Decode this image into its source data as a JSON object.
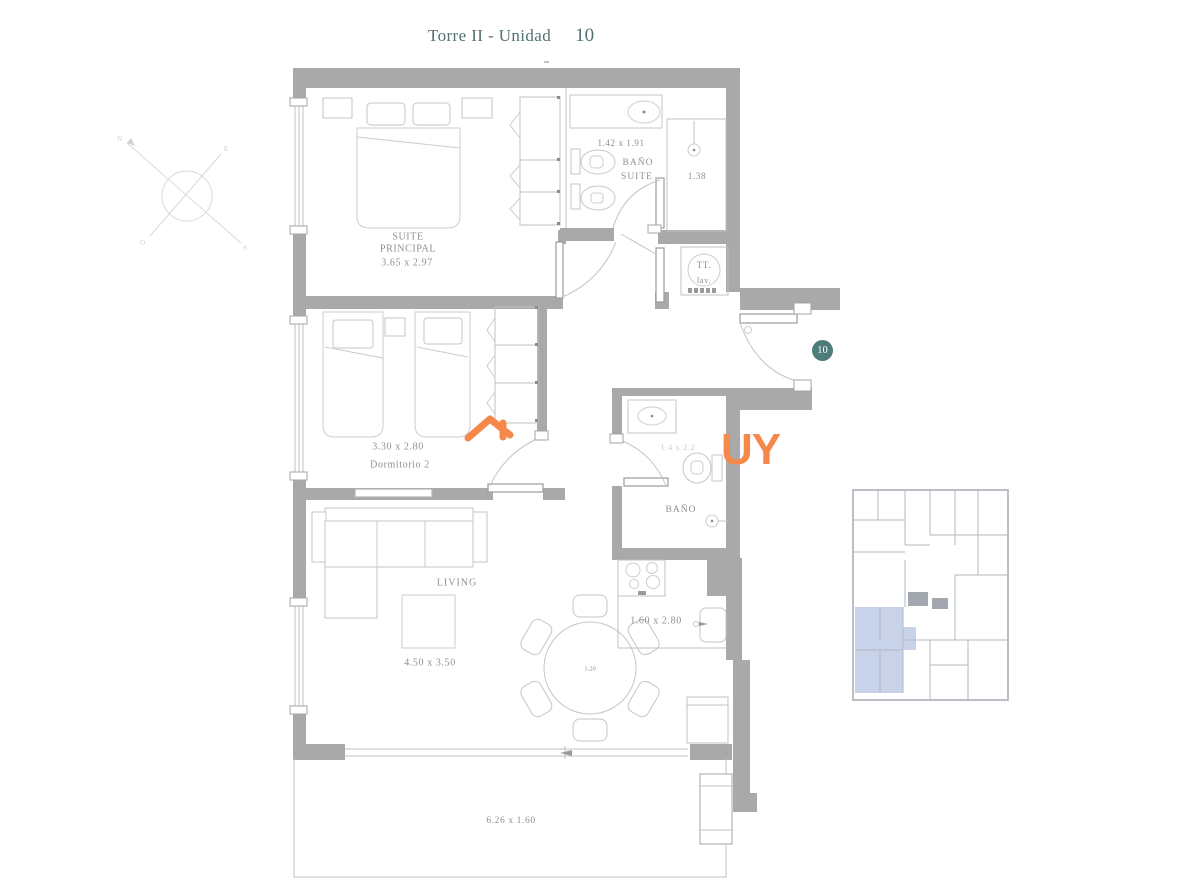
{
  "title": {
    "text": "Torre II - Unidad",
    "unit": "10"
  },
  "unit_badge": "10",
  "compass": {
    "north": "N",
    "east": "E",
    "south": "S",
    "west": "O"
  },
  "labels": {
    "suite_name_1": "SUITE",
    "suite_name_2": "PRINCIPAL",
    "suite_dim": "3.65 x 2.97",
    "bano_suite_dim": "1.42 x 1.91",
    "bano_suite_1": "BAÑO",
    "bano_suite_2": "SUITE",
    "shower_dim": "1.38",
    "tt_1": "TT.",
    "tt_2": "lav.",
    "dorm2_dim": "3.30 x 2.80",
    "dorm2_name": "Dormitorio 2",
    "bano2_dim": "1.4 x 2.2",
    "bano2_name": "BAÑO",
    "living_name": "LIVING",
    "living_dim": "4.50 x 3.50",
    "kitchen_dim": "1.60 x 2.80",
    "table_dim": "1.20",
    "terrace_dim": "6.26 x 1.60"
  },
  "watermark": {
    "text": "UY"
  },
  "colors": {
    "wall": "#a9a9a9",
    "furn": "#c0c0c0",
    "label_text": "#8f8f8f",
    "title_text": "#50716f",
    "badge_bg": "#4e7c7b",
    "badge_text": "#ffffff",
    "accent_orange": "#f6884b",
    "keyplan_highlight": "#c8d2e9",
    "keyplan_line": "#b3b8bf"
  }
}
